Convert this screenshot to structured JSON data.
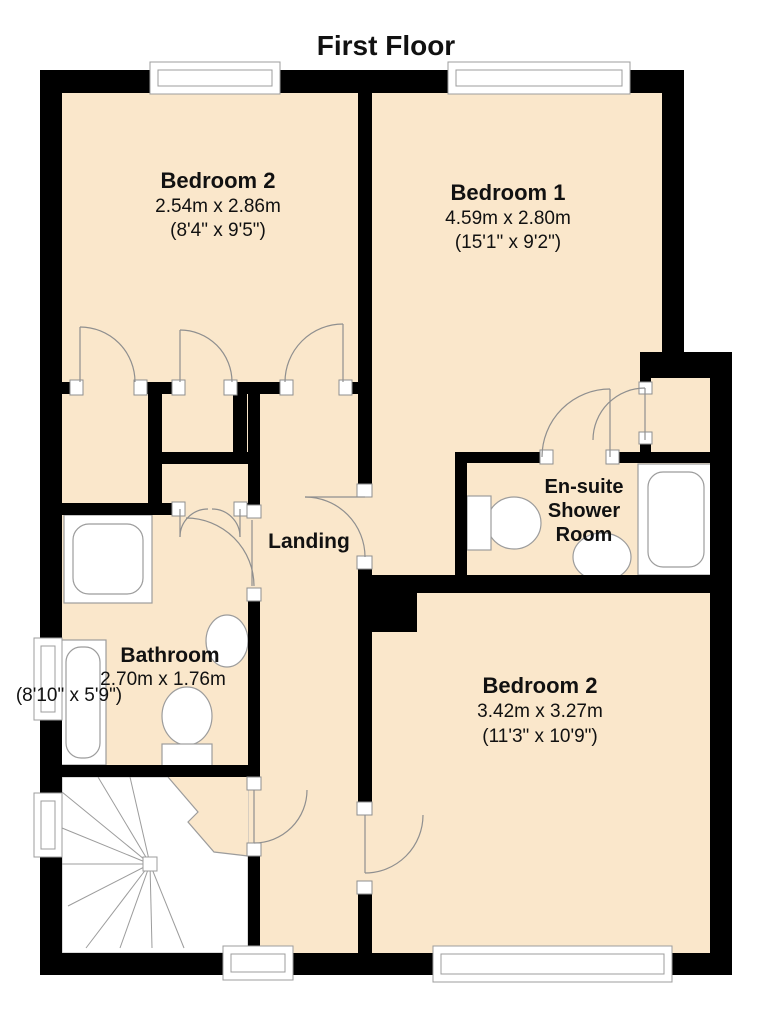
{
  "title": "First Floor",
  "colors": {
    "floor_fill": "#FAE7CB",
    "wall": "#000000",
    "fixture_outline": "#9C9C9C",
    "background": "#FFFFFF",
    "text": "#111111"
  },
  "rooms": [
    {
      "name": "Bedroom 2",
      "metric": "2.54m x 2.86m",
      "imperial": "(8'4\" x 9'5\")"
    },
    {
      "name": "Bedroom 1",
      "metric": "4.59m x 2.80m",
      "imperial": "(15'1\" x 9'2\")"
    },
    {
      "name_lines": [
        "En-suite",
        "Shower",
        "Room"
      ]
    },
    {
      "name": "Landing"
    },
    {
      "name": "Bathroom",
      "metric": "2.70m x 1.76m",
      "imperial": "(8'10\" x 5'9\")"
    },
    {
      "name": "Bedroom 2",
      "metric": "3.42m x 3.27m",
      "imperial": "(11'3\" x 10'9\")"
    }
  ]
}
